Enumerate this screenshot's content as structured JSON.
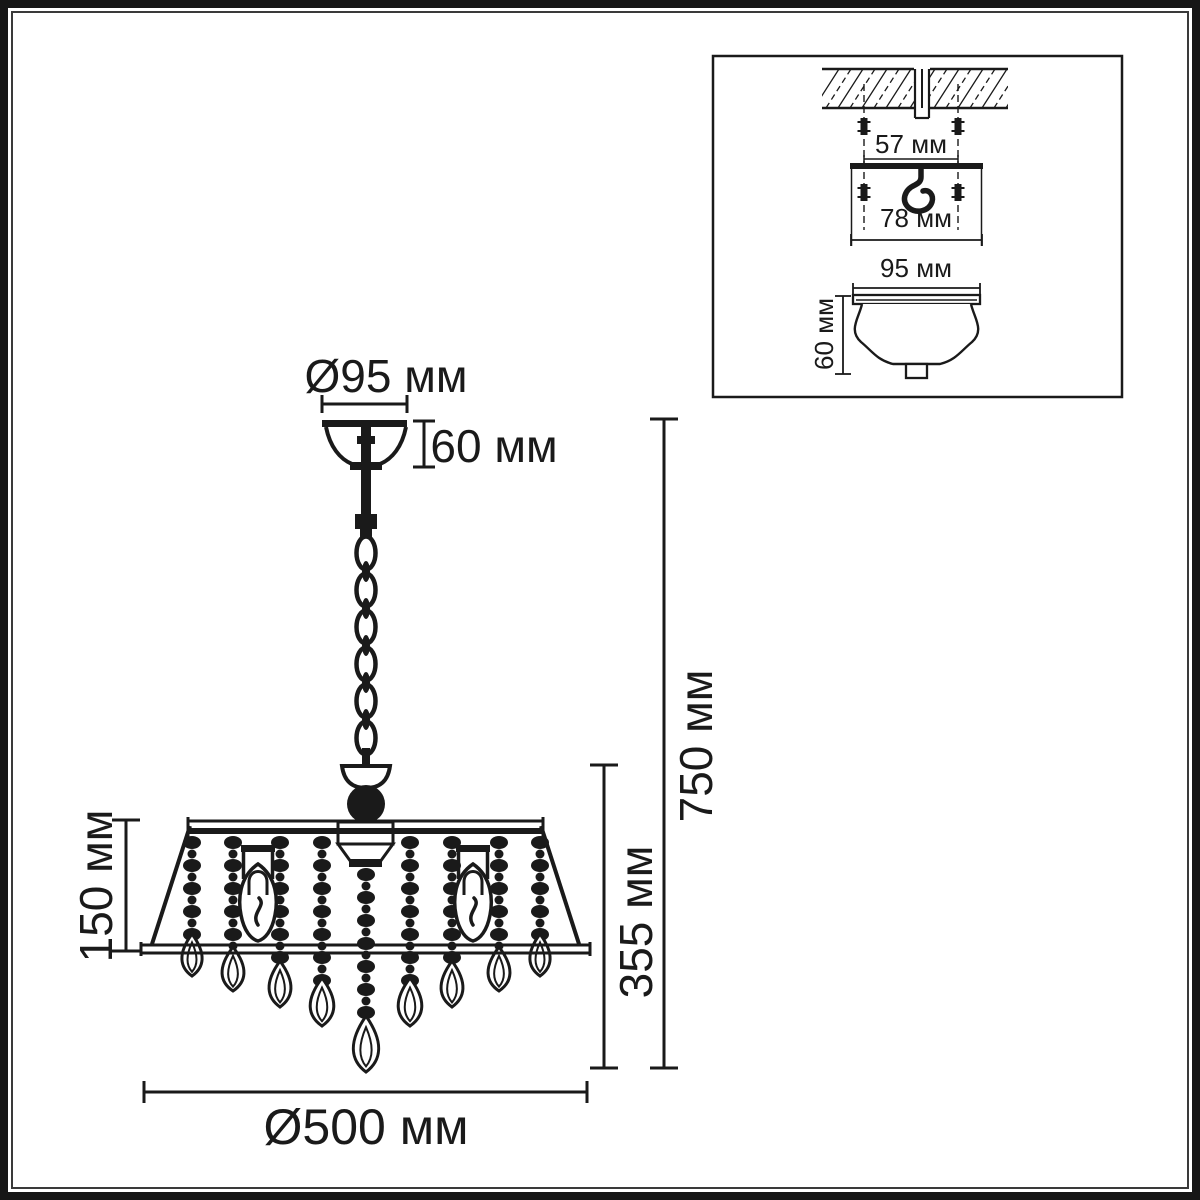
{
  "colors": {
    "ink": "#1a1a1a",
    "background": "#ffffff"
  },
  "main_view": {
    "name": "chandelier front view with dimensions",
    "dimensions": {
      "canopy_diameter": "Ø95 мм",
      "canopy_height": "60 мм",
      "shade_height": "150 мм",
      "body_height": "355 мм",
      "total_height": "750 мм",
      "overall_diameter": "Ø500 мм"
    }
  },
  "inset_view": {
    "name": "ceiling mounting detail",
    "dimensions": {
      "anchor_spacing": "57 мм",
      "bracket_width": "78 мм",
      "canopy_diameter": "95 мм",
      "canopy_height": "60 мм"
    }
  }
}
